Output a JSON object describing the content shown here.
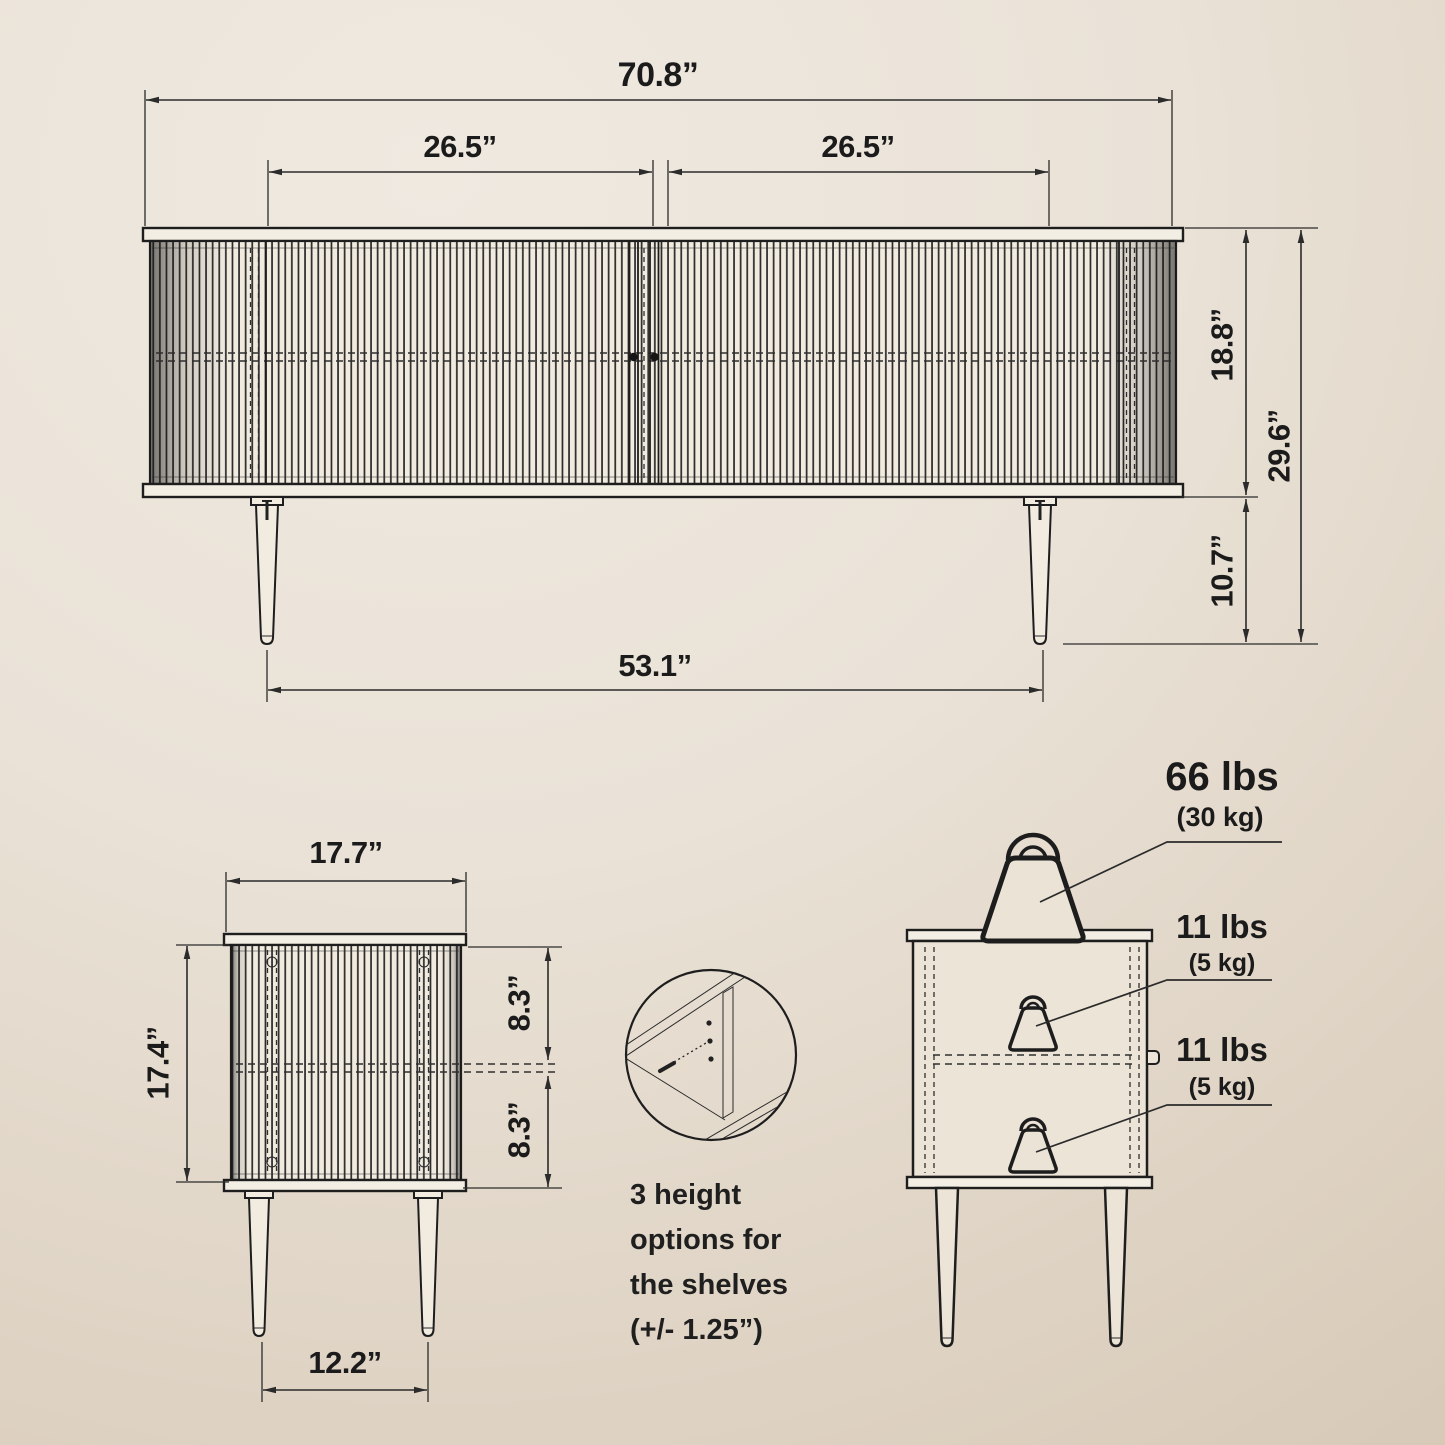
{
  "front_view": {
    "overall_width": "70.8”",
    "left_door_width": "26.5”",
    "right_door_width": "26.5”",
    "cabinet_body_height": "18.8”",
    "overall_height": "29.6”",
    "leg_height": "10.7”",
    "leg_span": "53.1”"
  },
  "side_view": {
    "depth": "17.7”",
    "cabinet_body_height": "17.4”",
    "upper_compartment_height": "8.3”",
    "lower_compartment_height": "8.3”",
    "leg_span": "12.2”"
  },
  "shelf_note": {
    "line1": "3 height",
    "line2": "options for",
    "line3": "the shelves",
    "line4": "(+/- 1.25”)"
  },
  "load_capacity": {
    "tabletop_lbs": "66 lbs",
    "tabletop_kg": "(30 kg)",
    "upper_shelf_lbs": "11 lbs",
    "upper_shelf_kg": "(5 kg)",
    "lower_shelf_lbs": "11 lbs",
    "lower_shelf_kg": "(5 kg)"
  },
  "colors": {
    "background_light": "#efe9e0",
    "background_dark": "#d3c3af",
    "line_ink": "#1e1e1e",
    "panel_fill": "#f1ebe0"
  }
}
